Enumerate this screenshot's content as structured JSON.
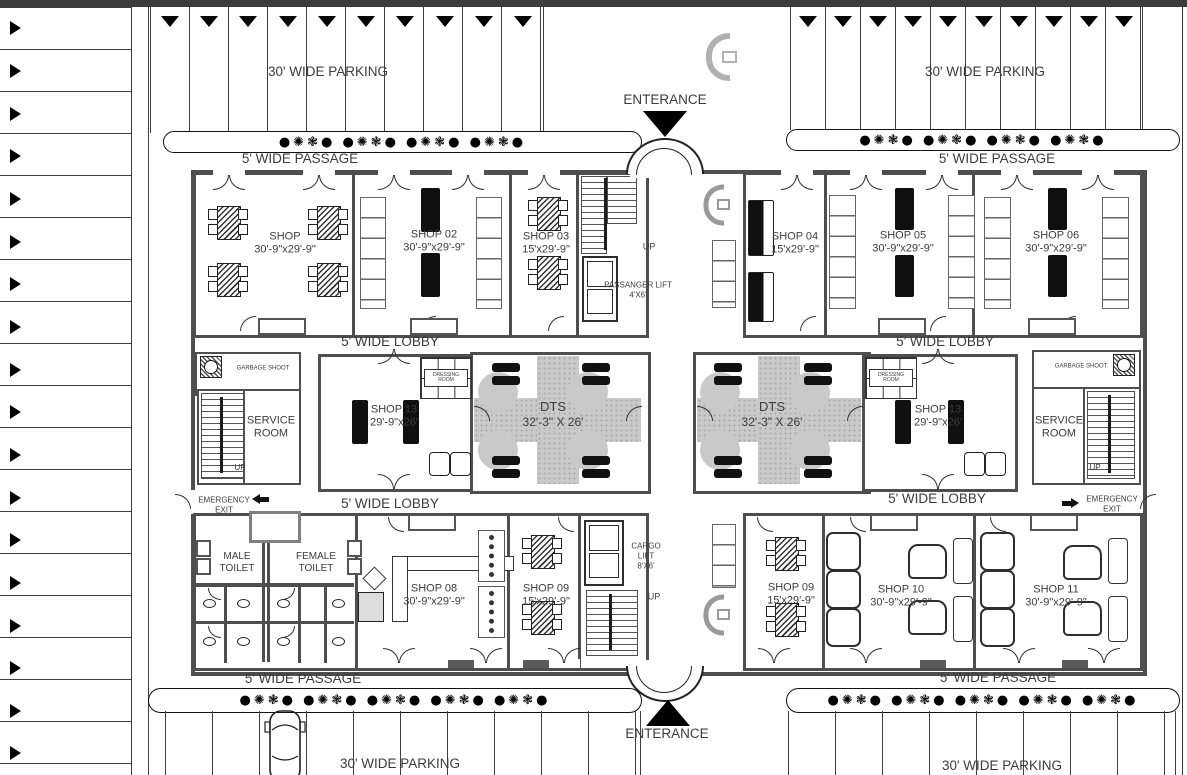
{
  "labels": {
    "parking_tl": "30' WIDE PARKING",
    "parking_tr": "30' WIDE PARKING",
    "parking_bl": "30'  WIDE PARKING",
    "parking_br": "30' WIDE PARKING",
    "passage_tl": "5' WIDE PASSAGE",
    "passage_tr": "5' WIDE PASSAGE",
    "passage_bl": "5' WIDE PASSAGE",
    "passage_br": "5' WIDE PASSAGE",
    "lobby_tl": "5' WIDE LOBBY",
    "lobby_tr": "5' WIDE LOBBY",
    "lobby_bl": "5' WIDE LOBBY",
    "lobby_br": "5' WIDE LOBBY",
    "entrance_top": "ENTERANCE",
    "entrance_bottom": "ENTERANCE"
  },
  "rooms": {
    "shop01": {
      "name": "SHOP",
      "dims": "30'-9\"x29'-9\""
    },
    "shop02": {
      "name": "SHOP 02",
      "dims": "30'-9\"x29'-9\""
    },
    "shop03": {
      "name": "SHOP 03",
      "dims": "15'x29'-9\""
    },
    "shop04": {
      "name": "SHOP 04",
      "dims": "15'x29'-9\""
    },
    "shop05": {
      "name": "SHOP 05",
      "dims": "30'-9\"x29'-9\""
    },
    "shop06": {
      "name": "SHOP 06",
      "dims": "30'-9\"x29'-9\""
    },
    "shop08": {
      "name": "SHOP 08",
      "dims": "30'-9\"x29'-9\""
    },
    "shop09_left": {
      "name": "SHOP 09",
      "dims": "15'x29'-9\""
    },
    "shop09_right": {
      "name": "SHOP 09",
      "dims": "15'x29'-9\""
    },
    "shop10": {
      "name": "SHOP 10",
      "dims": "30'-9\"x29'-9\""
    },
    "shop11": {
      "name": "SHOP 11",
      "dims": "30'-9\"x29'-9\""
    },
    "shop13_left": {
      "name": "SHOP 13",
      "dims": "29'-9\"x26'"
    },
    "shop13_right": {
      "name": "SHOP 13",
      "dims": "29'-9\"x26'"
    },
    "dts_left": {
      "name": "DTS",
      "dims": "32'-3\" X 26'"
    },
    "dts_right": {
      "name": "DTS",
      "dims": "32'-3\" X 26'"
    }
  },
  "areas": {
    "male_toilet": "MALE TOILET",
    "female_toilet": "FEMALE TOILET",
    "service_room": "SERVICE ROOM",
    "garbage_shoot": "GARBAGE SHOOT",
    "dressing_room": "DRESSING ROOM",
    "emergency_exit": "EMERGENCY EXIT",
    "up": "UP"
  },
  "lifts": {
    "passenger": {
      "name": "PASSANGER LIFT",
      "size": "4'X6'"
    },
    "cargo": {
      "name": "CARGO LIFT",
      "size": "8'X6'"
    }
  },
  "planters": {
    "trees_tl": "●✺❃●  ●✺❃●  ●✺❃●  ●✺❃●",
    "trees_tr": "●✺❃●  ●✺❃●  ●✺❃●  ●✺❃●",
    "trees_bl": "●✺❃●  ●✺❃●  ●✺❃●  ●✺❃●  ●✺❃●",
    "trees_br": "●✺❃●  ●✺❃●  ●✺❃●  ●✺❃●  ●✺❃●"
  },
  "colors": {
    "wall": "#4e4e4e",
    "text": "#3c3c3c",
    "carpet": "#c9c9c9",
    "chrome": "#3c3c3c"
  }
}
